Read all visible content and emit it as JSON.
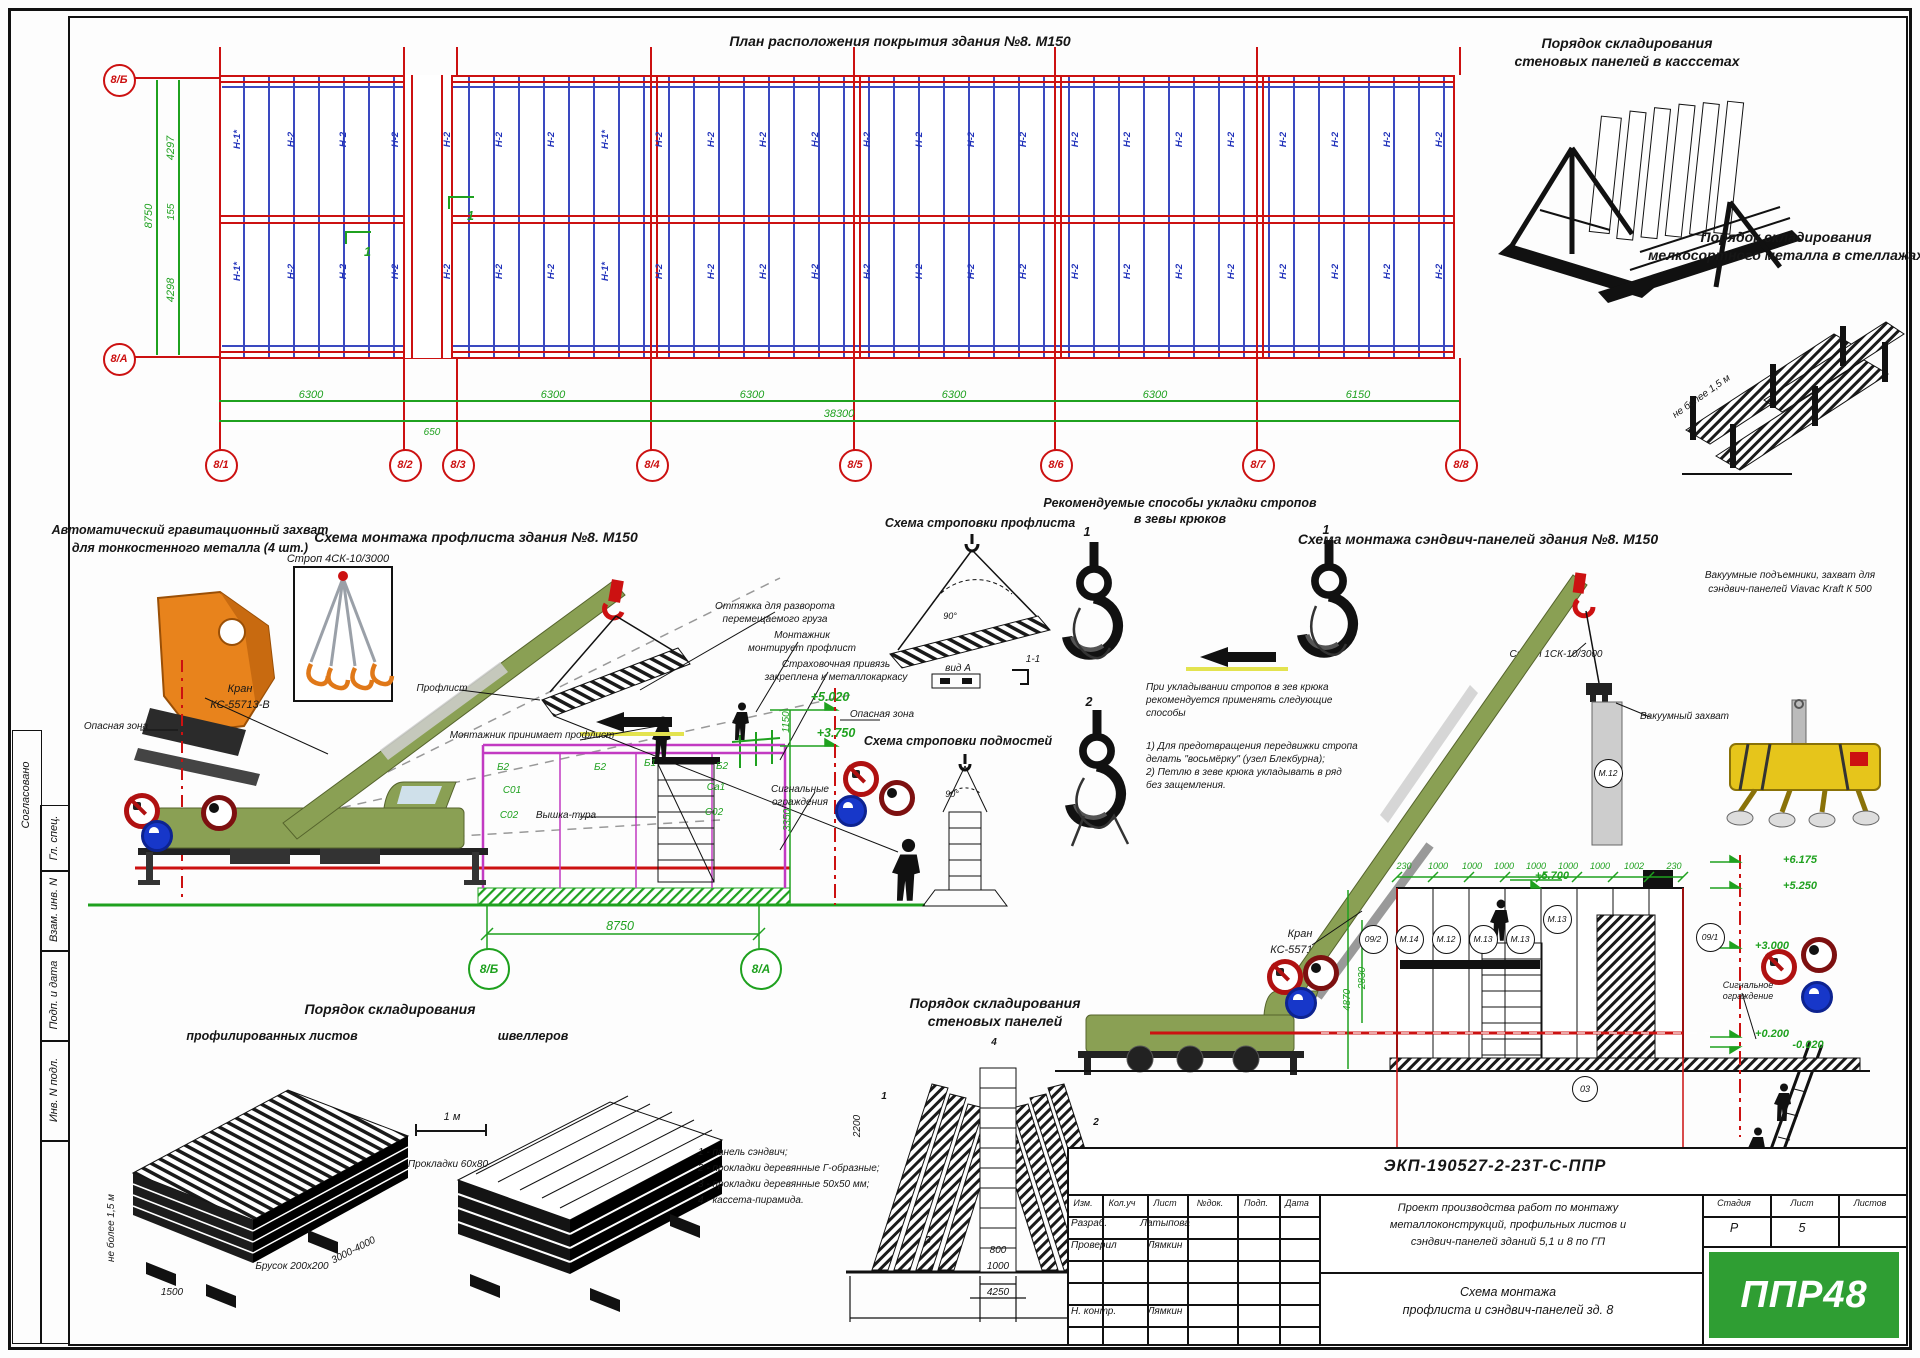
{
  "plan": {
    "title": "План расположения покрытия здания №8. М150",
    "ax": [
      "8/1",
      "8/2",
      "8/3",
      "8/4",
      "8/5",
      "8/6",
      "8/7",
      "8/8"
    ],
    "axv": [
      "8/Б",
      "8/А"
    ],
    "d": [
      "6300",
      "6300",
      "6300",
      "6300",
      "6300",
      "6150"
    ],
    "total": "38300",
    "gap": "650",
    "dl": [
      "4297",
      "155",
      "4298"
    ],
    "dlt": "8750",
    "p": "Н-2",
    "pe": "Н-1*",
    "flag": "1"
  },
  "cass": {
    "t1": "Порядок складирования",
    "t2": "стеновых панелей в касссетах"
  },
  "rack": {
    "t1": "Порядок складирования",
    "t2": "мелкосортного металла в стеллажах",
    "note": "не более 1,5 м"
  },
  "grab": {
    "t1": "Автоматический гравитационный захват",
    "t2": "для тонкостенного металла (4 шт.)"
  },
  "s1": {
    "title": "Схема монтажа профлиста здания №8.  М150",
    "strop": "Строп 4СК-10/3000",
    "crane1": "Кран",
    "crane2": "КС-55713-В",
    "dangerL": "Опасная зона",
    "dangerR": "Опасная зона",
    "ot1": "Оттяжка для разворота",
    "ot2": "перемещаемого груза",
    "mm1": "Монтажник",
    "mm2": "монтирует профлист",
    "sp1": "Страховочная привязь",
    "sp2": "закреплена к металлокаркасу",
    "prof": "Профлист",
    "prin": "Монтажник принимает профлист",
    "tower": "Вышка-тура",
    "fen1": "Сигнальные",
    "fen2": "ограждения",
    "e1": "+5.020",
    "e2": "+3.750",
    "d1": "1150",
    "d2": "3350",
    "f1": "Б2",
    "f2": "С01",
    "f3": "С02",
    "f4": "Б2",
    "f5": "Б1",
    "f6": "Б2",
    "f7": "Са1",
    "f8": "С02",
    "dim": "8750",
    "axl": "8/Б",
    "axr": "8/А"
  },
  "sa": {
    "title": "Схема строповки профлиста",
    "vida": "вид А",
    "d11": "1-1",
    "ang": "90°"
  },
  "sb": {
    "title": "Схема строповки подмостей",
    "ang": "90°"
  },
  "hk": {
    "t1": "Рекомендуемые способы укладки стропов",
    "t2": "в зевы крюков",
    "n1": "1",
    "n2": "1",
    "n3": "2",
    "p1": "При укладывании стропов в зев крюка",
    "p2": "рекомендуется применять следующие",
    "p3": "способы",
    "q1": "1) Для предотвращения передвижки стропа",
    "q2": "делать \"восьмёрку\" (узел Блекбурна);",
    "q3": "2) Петлю в зеве крюка укладывать в ряд",
    "q4": "без защемления."
  },
  "s2": {
    "title": "Схема монтажа сэндвич-панелей здания №8. М150",
    "strop": "Строп 1СК-10/3000",
    "vac": "Вакуумный захват",
    "note1": "Вакуумные подъемники, захват для",
    "note2": "сэндвич-панелей Viavac Kraft К 500",
    "crane1": "Кран",
    "crane2": "КС-55713-В",
    "dt": [
      "230",
      "1000",
      "1000",
      "1000",
      "1000",
      "1000",
      "1000",
      "1002",
      "230"
    ],
    "panels": [
      "09/2",
      "М.14",
      "М.12",
      "М.13",
      "М.13",
      "М.13",
      "09/1"
    ],
    "hang": "М.12",
    "e1": "+6.175",
    "e2": "+5.250",
    "e3": "+5.700",
    "e4": "+3.000",
    "e5": "+0.200",
    "e6": "-0.020",
    "v1": "4870",
    "v2": "2830",
    "fen1": "Сигнальное",
    "fen2": "ограждение",
    "dim": "8750",
    "axl": "8/А",
    "axr": "8/Б",
    "m03": "03"
  },
  "st1": {
    "t": "Порядок складирования",
    "s1": "профилированных листов",
    "s2": "швеллеров",
    "m": "1 м",
    "pr": "Прокладки 60x80",
    "br": "Брусок 200x200",
    "h": "не более 1,5 м",
    "d1": "1500",
    "d2": "3000-4000"
  },
  "st2": {
    "t1": "Порядок складирования",
    "t2": "стеновых панелей",
    "n1": "1 - панель сэндвич;",
    "n2": "2 - прокладки деревянные Г-образные;",
    "n3": "3 - прокладки деревянные 50х50 мм;",
    "n4": "4 - кассета-пирамида.",
    "d1": "800",
    "d2": "1000",
    "d3": "4250",
    "d4": "2200",
    "k1": "1",
    "k2": "2",
    "k3": "3",
    "k4": "4"
  },
  "tb": {
    "num": "ЭКП-190527-2-23Т-С-ППР",
    "h": [
      "Изм.",
      "Кол.уч",
      "Лист",
      "№док.",
      "Подп.",
      "Дата"
    ],
    "r1": "Разраб.",
    "r1n": "Латыпова",
    "r2": "Проверил",
    "r2n": "Лямкин",
    "r3": "Н. контр.",
    "r3n": "Лямкин",
    "p1": "Проект производства работ по монтажу",
    "p2": "металлоконструкций, профильных листов и",
    "p3": "сэндвич-панелей зданий 5,1 и 8 по ГП",
    "nm1": "Схема монтажа",
    "nm2": "профлиста и сэндвич-панелей зд. 8",
    "st": "Стадия",
    "li": "Лист",
    "lo": "Листов",
    "stv": "Р",
    "liv": "5",
    "logo": "ППР48"
  },
  "mg": {
    "m1": "Согласовано",
    "m2": "Гл. спец.",
    "m3": "Взам. инв. N",
    "m4": "Подп. и дата",
    "m5": "Инв. N подл."
  }
}
